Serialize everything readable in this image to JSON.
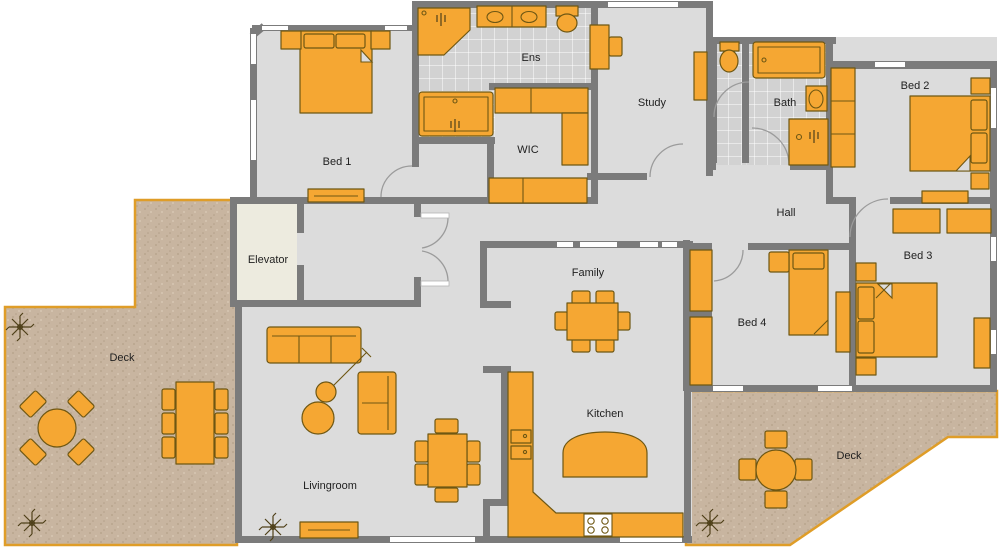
{
  "rooms": {
    "bed1": {
      "label": "Bed 1"
    },
    "ens": {
      "label": "Ens"
    },
    "wic": {
      "label": "WIC"
    },
    "study": {
      "label": "Study"
    },
    "bath": {
      "label": "Bath"
    },
    "bed2": {
      "label": "Bed 2"
    },
    "hall": {
      "label": "Hall"
    },
    "elevator": {
      "label": "Elevator"
    },
    "bed3": {
      "label": "Bed 3"
    },
    "bed4": {
      "label": "Bed 4"
    },
    "family": {
      "label": "Family"
    },
    "kitchen": {
      "label": "Kitchen"
    },
    "livingroom": {
      "label": "Livingroom"
    },
    "deck_left": {
      "label": "Deck"
    },
    "deck_right": {
      "label": "Deck"
    }
  },
  "palette": {
    "wall": "#7b7b7b",
    "floor": "#dcdcdc",
    "tile_floor": "#d2d2d2",
    "tile_line": "#ffffff",
    "elevator_floor": "#edebdf",
    "furniture": "#f5a733",
    "furniture_outline": "#6e5713",
    "deck": "#c8b5a0",
    "deck_speckle_dark": "#b3a089",
    "deck_speckle_light": "#dcccb8",
    "deck_border": "#df9d28",
    "label_text": "#1f1f1f",
    "plant": "#4f4019",
    "door_arc": "#9b9b9b",
    "window": "#ffffff"
  }
}
